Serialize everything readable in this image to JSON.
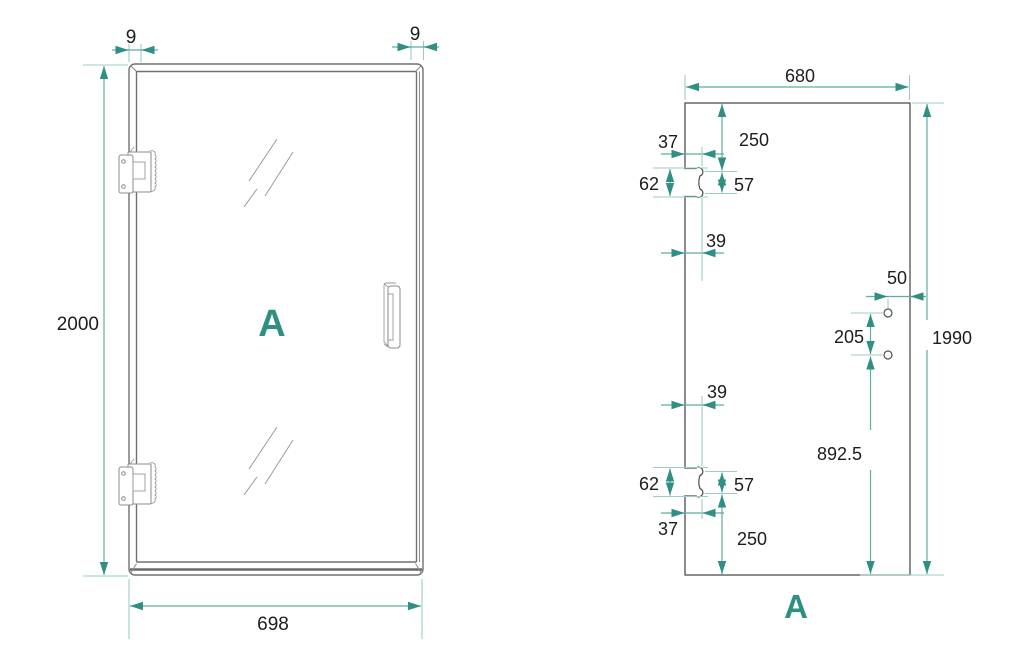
{
  "colors": {
    "accent_teal": "#2e8f82",
    "dimension_line": "#5fada1",
    "extension_line": "#9ccdc4",
    "drawing_line": "#707070",
    "text": "#1d1d1d",
    "background": "#ffffff"
  },
  "left_view": {
    "label": "A",
    "dims": {
      "total_height": "2000",
      "total_width": "698",
      "profile_left": "9",
      "profile_right": "9"
    }
  },
  "right_view": {
    "label": "A",
    "dims": {
      "glass_width": "680",
      "glass_height": "1990",
      "top_to_hinge": "250",
      "hinge_top_inset": "37",
      "hinge_cutout_height_top": "62",
      "hinge_hole_spacing_top": "57",
      "hinge_cutout_width_top": "39",
      "handle_edge_offset": "50",
      "handle_hole_spacing": "205",
      "handle_to_bottom": "892.5",
      "hinge_cutout_width_bottom": "39",
      "hinge_cutout_height_bottom": "62",
      "hinge_hole_spacing_bottom": "57",
      "hinge_bottom_inset": "37",
      "bottom_to_hinge": "250"
    }
  }
}
